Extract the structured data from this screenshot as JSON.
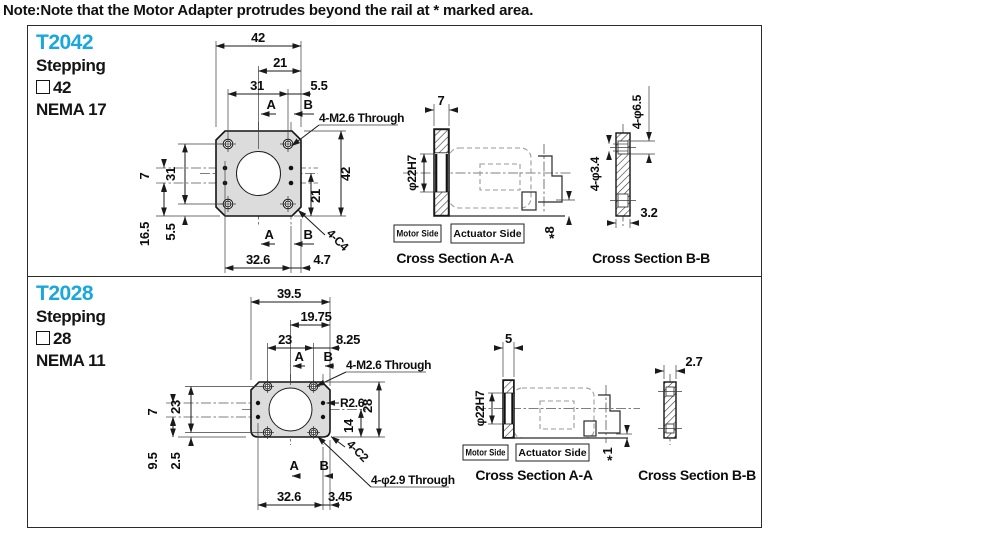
{
  "note": "Note:Note that the Motor Adapter protrudes beyond the rail at * marked area.",
  "colors": {
    "accent": "#1aa7dc",
    "asterisk": "#ec008c",
    "plate_fill": "#dcdcdc"
  },
  "panels": [
    {
      "model": "T2042",
      "type_label": "Stepping",
      "size": "42",
      "nema": "NEMA 17",
      "front": {
        "w_total": "42",
        "w_half": "21",
        "w_holes": "31",
        "w_edge": "5.5",
        "a": "A",
        "b": "B",
        "thread": "4-M2.6 Through",
        "v_pitch": "7",
        "v_holes": "31",
        "v_low": "16.5",
        "v_edge": "5.5",
        "h_total": "42",
        "h_half": "21",
        "b_width": "32.6",
        "b_edge": "4.7",
        "corner": "4-C4"
      },
      "aa": {
        "t": "7",
        "bore": "φ22H7",
        "motor": "Motor Side",
        "actuator": "Actuator Side",
        "star": "*",
        "prot": "8",
        "caption": "Cross Section A-A"
      },
      "bb": {
        "cbore": "4-φ6.5",
        "hole": "4-φ3.4",
        "depth": "3.2",
        "caption": "Cross Section B-B"
      }
    },
    {
      "model": "T2028",
      "type_label": "Stepping",
      "size": "28",
      "nema": "NEMA 11",
      "front": {
        "w_total": "39.5",
        "w_half": "19.75",
        "w_holes": "23",
        "w_edge": "8.25",
        "a": "A",
        "b": "B",
        "thread": "4-M2.6 Through",
        "radius": "R2.6",
        "v_pitch": "7",
        "v_holes": "23",
        "v_low": "9.5",
        "v_edge": "2.5",
        "h_total": "28",
        "h_half": "14",
        "b_width": "32.6",
        "b_edge": "3.45",
        "corner": "4-C2",
        "drill": "4-φ2.9 Through"
      },
      "aa": {
        "t": "5",
        "bore": "φ22H7",
        "motor": "Motor Side",
        "actuator": "Actuator Side",
        "star": "*",
        "prot": "1",
        "caption": "Cross Section A-A"
      },
      "bb": {
        "depth": "2.7",
        "caption": "Cross Section B-B"
      }
    }
  ]
}
